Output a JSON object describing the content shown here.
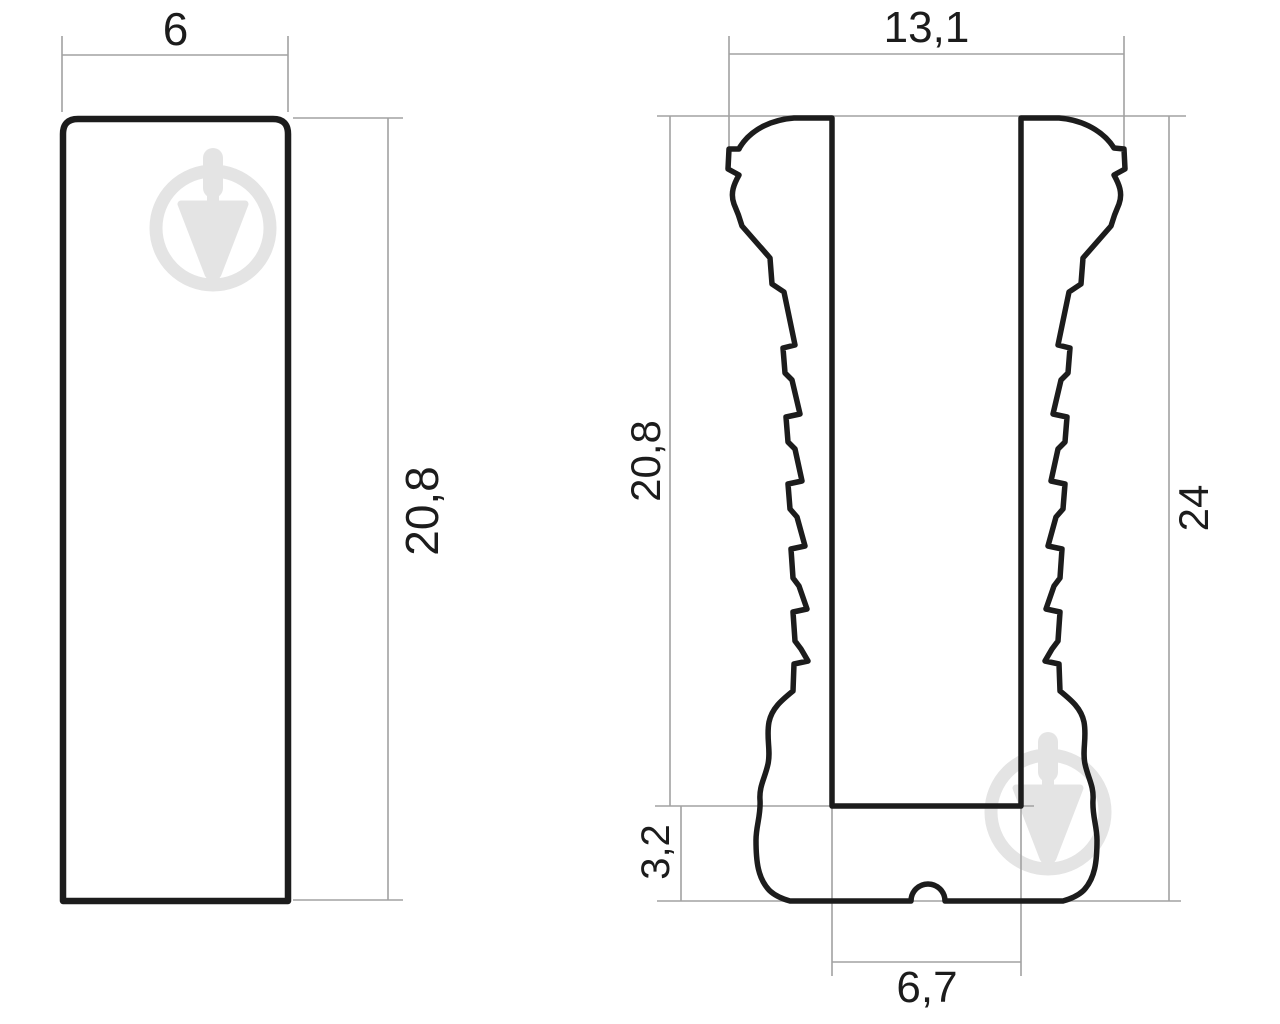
{
  "drawing": {
    "title": "dowel plug technical drawing, two views",
    "left_view": {
      "shape": "rounded-top rectangular profile",
      "dimensions": {
        "width_top": {
          "label": "6",
          "orientation": "horizontal",
          "position": "top"
        },
        "height_right": {
          "label": "20,8",
          "orientation": "vertical",
          "position": "right"
        }
      }
    },
    "right_view": {
      "shape": "ribbed expansion cross-section with center slot and base foot",
      "dimensions": {
        "width_top": {
          "label": "13,1",
          "orientation": "horizontal",
          "position": "top"
        },
        "slot_depth_left": {
          "label": "20,8",
          "orientation": "vertical",
          "position": "left"
        },
        "total_height_right": {
          "label": "24",
          "orientation": "vertical",
          "position": "right"
        },
        "base_height": {
          "label": "3,2",
          "orientation": "vertical",
          "position": "bottom-left"
        },
        "slot_width_bottom": {
          "label": "6,7",
          "orientation": "horizontal",
          "position": "bottom"
        }
      }
    },
    "colors": {
      "outline": "#1c1c1c",
      "dimension_line": "#a2a2a2",
      "watermark": "#e4e4e4",
      "background": "#ffffff"
    }
  }
}
